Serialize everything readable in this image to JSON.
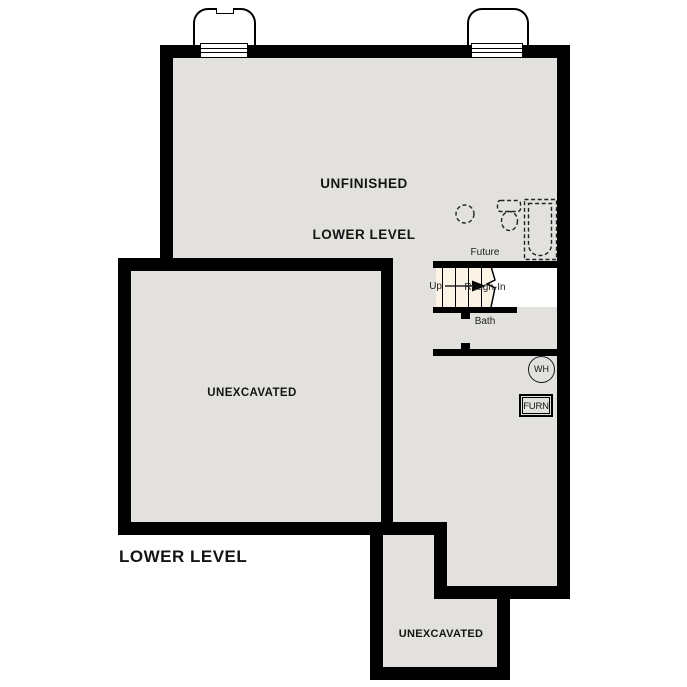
{
  "plan_title": "LOWER LEVEL",
  "labels": {
    "unfinished_line1": "UNFINISHED",
    "unfinished_line2": "LOWER LEVEL",
    "unexcavated_main": "UNEXCAVATED",
    "unexcavated_lower": "UNEXCAVATED",
    "stairs_up": "Up",
    "bath_line1": "Future",
    "bath_line2": "Rough-In",
    "bath_line3": "Bath",
    "water_heater": "WH",
    "furnace": "FURN"
  },
  "colors": {
    "wall": "#000000",
    "floor": "#e3e1de",
    "stair_fill": "#faf3e6",
    "background": "#ffffff",
    "line": "#222222"
  },
  "icons": {
    "window_well": "rounded-well-outline",
    "egress_window": "triple-pane-window",
    "stair_up_arrow": "right-arrow",
    "stair_break_line": "zigzag-break",
    "bath_drain_rough_in": "dashed-circle",
    "toilet_rough_in": "dashed-toilet-outline",
    "tub_rough_in": "dashed-tub-outline",
    "water_heater": "circle-badge",
    "furnace": "double-border-box"
  }
}
